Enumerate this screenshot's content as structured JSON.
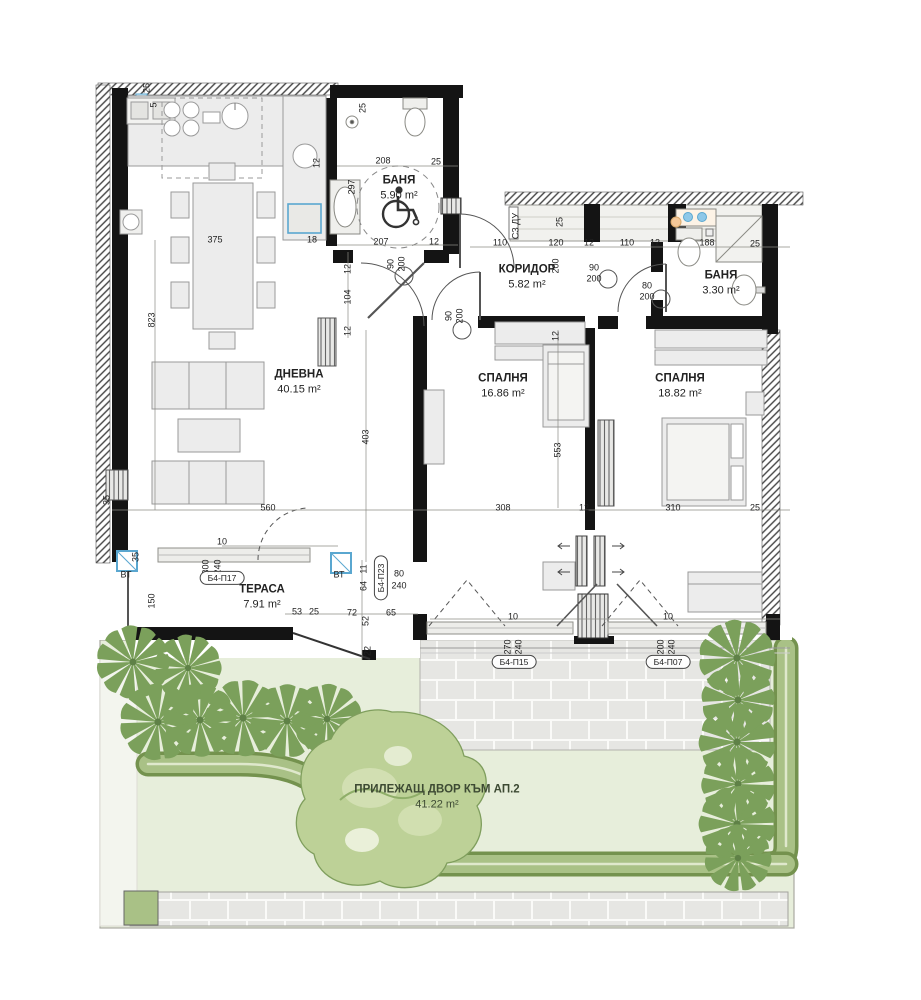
{
  "plan": {
    "rooms": [
      {
        "id": "dnevna",
        "label": "ДНЕВНА",
        "area": "40.15 m²"
      },
      {
        "id": "banya-1",
        "label": "БАНЯ",
        "area": "5.90 m²"
      },
      {
        "id": "koridor",
        "label": "КОРИДОР",
        "area": "5.82 m²"
      },
      {
        "id": "banya-2",
        "label": "БАНЯ",
        "area": "3.30 m²"
      },
      {
        "id": "spalnya-1",
        "label": "СПАЛНЯ",
        "area": "16.86 m²"
      },
      {
        "id": "spalnya-2",
        "label": "СПАЛНЯ",
        "area": "18.82 m²"
      },
      {
        "id": "terasa",
        "label": "ТЕРАСА",
        "area": "7.91 m²"
      },
      {
        "id": "dvor",
        "label": "ПРИЛЕЖАЩ ДВОР КЪМ АП.2",
        "area": "41.22 m²"
      }
    ],
    "tags": [
      {
        "label": "Б4-П17",
        "x": 222,
        "y": 578,
        "v": false
      },
      {
        "label": "Б4-П23",
        "x": 381,
        "y": 578,
        "v": true
      },
      {
        "label": "Б4-П15",
        "x": 514,
        "y": 662,
        "v": false
      },
      {
        "label": "Б4-П07",
        "x": 668,
        "y": 662,
        "v": false
      }
    ],
    "dims": [
      {
        "t": "25",
        "x": 147,
        "y": 88,
        "o": "v"
      },
      {
        "t": "5",
        "x": 154,
        "y": 105,
        "o": "v"
      },
      {
        "t": "375",
        "x": 215,
        "y": 240,
        "o": "h"
      },
      {
        "t": "18",
        "x": 312,
        "y": 240,
        "o": "h"
      },
      {
        "t": "12",
        "x": 317,
        "y": 163,
        "o": "v"
      },
      {
        "t": "25",
        "x": 363,
        "y": 108,
        "o": "v"
      },
      {
        "t": "208",
        "x": 383,
        "y": 161,
        "o": "h"
      },
      {
        "t": "25",
        "x": 436,
        "y": 162,
        "o": "h"
      },
      {
        "t": "297",
        "x": 352,
        "y": 187,
        "o": "v"
      },
      {
        "t": "207",
        "x": 381,
        "y": 242,
        "o": "h"
      },
      {
        "t": "12",
        "x": 434,
        "y": 242,
        "o": "h"
      },
      {
        "t": "90",
        "x": 391,
        "y": 264,
        "o": "v"
      },
      {
        "t": "200",
        "x": 402,
        "y": 264,
        "o": "v"
      },
      {
        "t": "12",
        "x": 348,
        "y": 269,
        "o": "v"
      },
      {
        "t": "104",
        "x": 348,
        "y": 297,
        "o": "v"
      },
      {
        "t": "12",
        "x": 348,
        "y": 331,
        "o": "v"
      },
      {
        "t": "90",
        "x": 449,
        "y": 316,
        "o": "v"
      },
      {
        "t": "200",
        "x": 460,
        "y": 316,
        "o": "v"
      },
      {
        "t": "110",
        "x": 500,
        "y": 243,
        "o": "h"
      },
      {
        "t": "120",
        "x": 556,
        "y": 243,
        "o": "h"
      },
      {
        "t": "12",
        "x": 589,
        "y": 243,
        "o": "h"
      },
      {
        "t": "110",
        "x": 627,
        "y": 243,
        "o": "h"
      },
      {
        "t": "12",
        "x": 655,
        "y": 243,
        "o": "h"
      },
      {
        "t": "188",
        "x": 707,
        "y": 243,
        "o": "h"
      },
      {
        "t": "25",
        "x": 755,
        "y": 244,
        "o": "h"
      },
      {
        "t": "25",
        "x": 560,
        "y": 222,
        "o": "v"
      },
      {
        "t": "СЗ ДУ",
        "x": 516,
        "y": 226,
        "o": "v"
      },
      {
        "t": "200",
        "x": 556,
        "y": 266,
        "o": "v"
      },
      {
        "t": "90",
        "x": 594,
        "y": 268,
        "o": "h"
      },
      {
        "t": "200",
        "x": 594,
        "y": 279,
        "o": "h"
      },
      {
        "t": "80",
        "x": 647,
        "y": 286,
        "o": "h"
      },
      {
        "t": "200",
        "x": 647,
        "y": 297,
        "o": "h"
      },
      {
        "t": "12",
        "x": 556,
        "y": 336,
        "o": "v"
      },
      {
        "t": "823",
        "x": 152,
        "y": 320,
        "o": "v"
      },
      {
        "t": "403",
        "x": 366,
        "y": 437,
        "o": "v"
      },
      {
        "t": "553",
        "x": 558,
        "y": 450,
        "o": "v"
      },
      {
        "t": "560",
        "x": 268,
        "y": 508,
        "o": "h"
      },
      {
        "t": "308",
        "x": 503,
        "y": 508,
        "o": "h"
      },
      {
        "t": "12",
        "x": 584,
        "y": 508,
        "o": "h"
      },
      {
        "t": "310",
        "x": 673,
        "y": 508,
        "o": "h"
      },
      {
        "t": "25",
        "x": 755,
        "y": 508,
        "o": "h"
      },
      {
        "t": "35",
        "x": 107,
        "y": 500,
        "o": "v"
      },
      {
        "t": "35",
        "x": 136,
        "y": 557,
        "o": "v"
      },
      {
        "t": "150",
        "x": 152,
        "y": 601,
        "o": "v"
      },
      {
        "t": "10",
        "x": 222,
        "y": 542,
        "o": "h"
      },
      {
        "t": "300",
        "x": 206,
        "y": 567,
        "o": "v"
      },
      {
        "t": "240",
        "x": 218,
        "y": 567,
        "o": "v"
      },
      {
        "t": "ВТ",
        "x": 126,
        "y": 575,
        "o": "h"
      },
      {
        "t": "ВТ",
        "x": 339,
        "y": 575,
        "o": "h"
      },
      {
        "t": "11",
        "x": 364,
        "y": 569,
        "o": "v"
      },
      {
        "t": "64",
        "x": 364,
        "y": 586,
        "o": "v"
      },
      {
        "t": "53",
        "x": 297,
        "y": 612,
        "o": "h"
      },
      {
        "t": "25",
        "x": 314,
        "y": 612,
        "o": "h"
      },
      {
        "t": "72",
        "x": 352,
        "y": 613,
        "o": "h"
      },
      {
        "t": "65",
        "x": 391,
        "y": 613,
        "o": "h"
      },
      {
        "t": "80",
        "x": 399,
        "y": 574,
        "o": "h"
      },
      {
        "t": "240",
        "x": 399,
        "y": 586,
        "o": "h"
      },
      {
        "t": "52",
        "x": 366,
        "y": 621,
        "o": "v"
      },
      {
        "t": "22",
        "x": 368,
        "y": 651,
        "o": "v"
      },
      {
        "t": "10",
        "x": 513,
        "y": 617,
        "o": "h"
      },
      {
        "t": "10",
        "x": 668,
        "y": 617,
        "o": "h"
      },
      {
        "t": "270",
        "x": 508,
        "y": 647,
        "o": "v"
      },
      {
        "t": "240",
        "x": 519,
        "y": 647,
        "o": "v"
      },
      {
        "t": "200",
        "x": 661,
        "y": 647,
        "o": "v"
      },
      {
        "t": "240",
        "x": 672,
        "y": 647,
        "o": "v"
      }
    ],
    "door_sizes_note": [
      "90/200",
      "80/200"
    ],
    "colors": {
      "wall": "#141414",
      "lawn": "#e7eedb",
      "hedge": "#a9c186",
      "shrub": "#7ba05b",
      "tree": "#bdd197",
      "accent_blue": "#5aa7d0",
      "accent_orange": "#f4c899",
      "furniture_fill": "#ececec"
    }
  }
}
